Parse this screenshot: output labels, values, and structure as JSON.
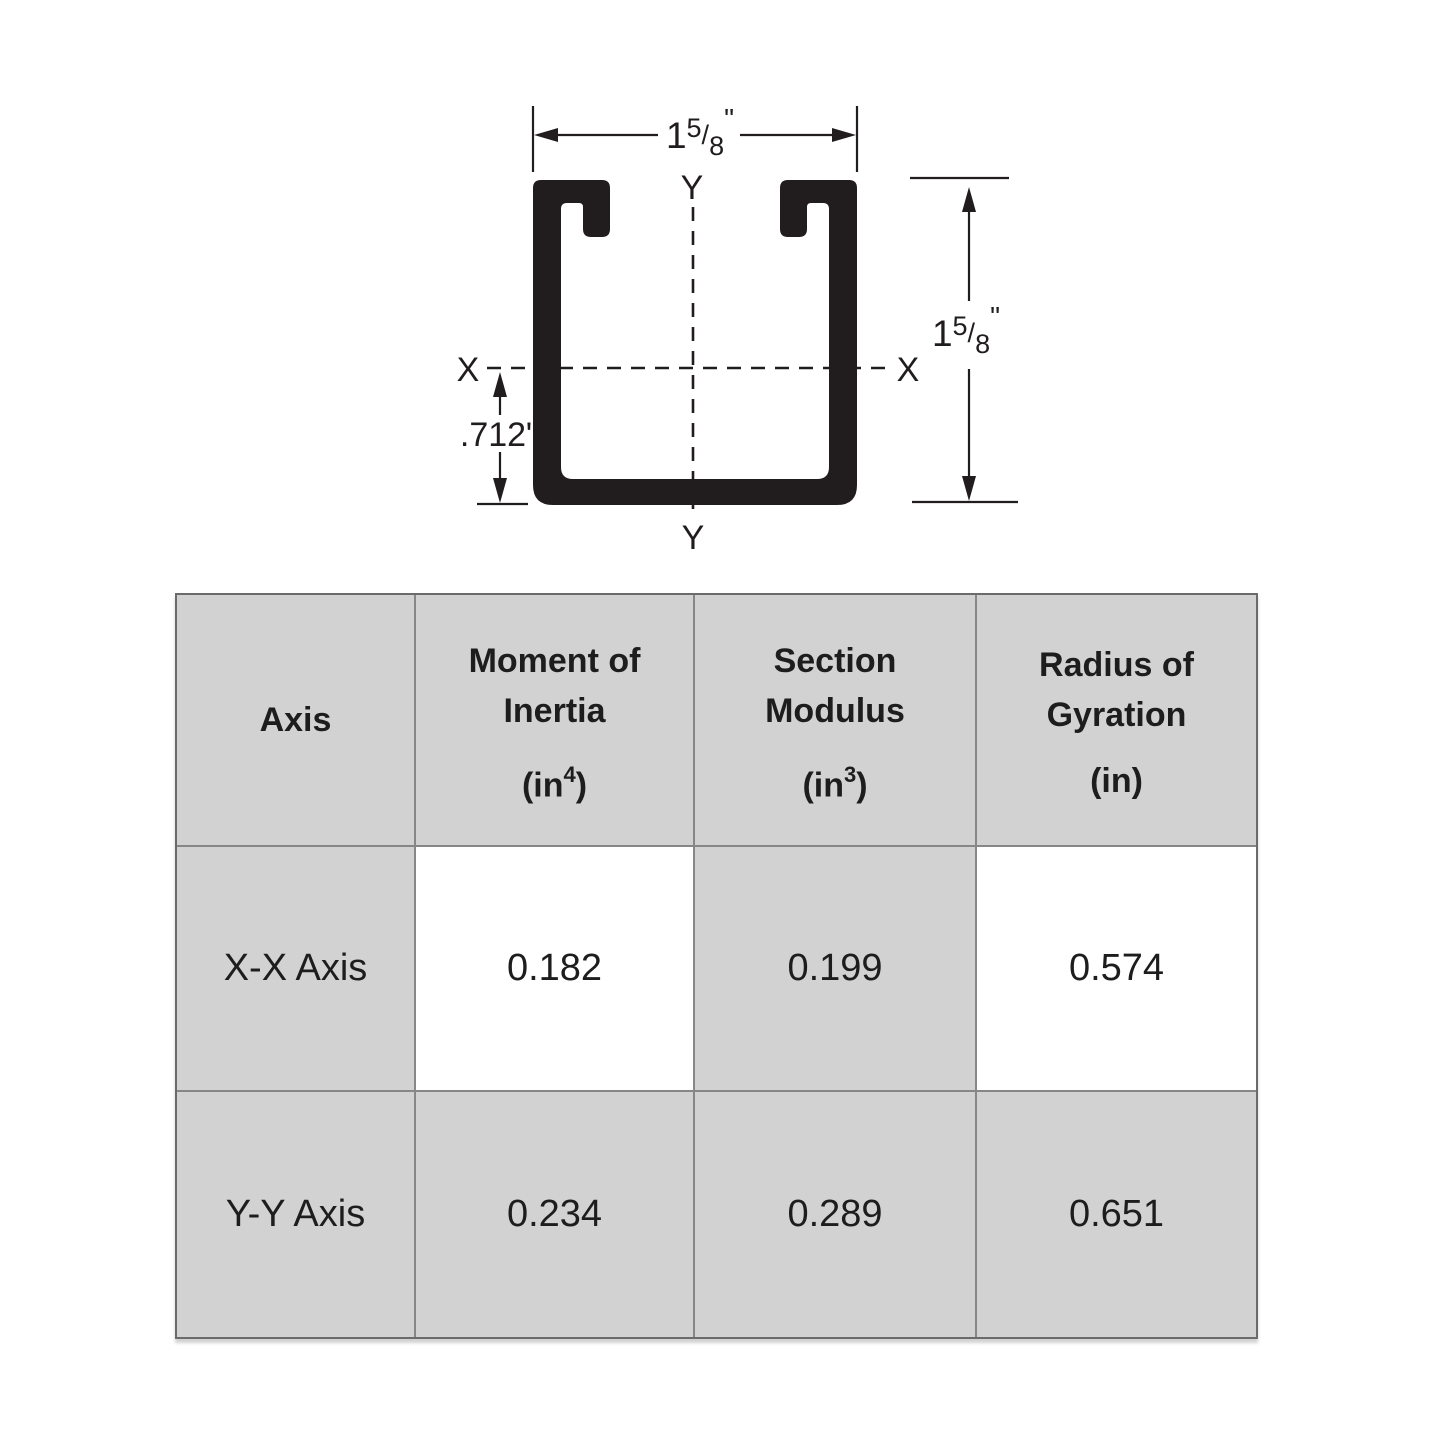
{
  "colors": {
    "ink": "#211d1e",
    "table_cell_gray": "#d2d2d2",
    "table_inner_border": "#878787",
    "table_outer_border": "#6b6b6b",
    "background": "#ffffff"
  },
  "diagram": {
    "width_dim": {
      "whole": "1",
      "num": "5",
      "sep": "/",
      "den": "8",
      "prime": "\""
    },
    "height_dim": {
      "whole": "1",
      "num": "5",
      "sep": "/",
      "den": "8",
      "prime": "\""
    },
    "offset_dim_label": ".712\"",
    "x_axis_label_left": "X",
    "x_axis_label_right": "X",
    "y_axis_label_top": "Y",
    "y_axis_label_bottom": "Y"
  },
  "table": {
    "headers": [
      {
        "line1": "Axis"
      },
      {
        "line1": "Moment of",
        "line2": "Inertia",
        "unit_prefix": "(",
        "unit_base": "in",
        "unit_sup": "4",
        "unit_suffix": ")"
      },
      {
        "line1": "Section",
        "line2": "Modulus",
        "unit_prefix": "(",
        "unit_base": "in",
        "unit_sup": "3",
        "unit_suffix": ")"
      },
      {
        "line1": "Radius of",
        "line2": "Gyration",
        "unit_prefix": "(",
        "unit_base": "in",
        "unit_suffix": ")"
      }
    ],
    "rows": [
      {
        "axis": "X-X Axis",
        "moment_of_inertia": "0.182",
        "section_modulus": "0.199",
        "radius_of_gyration": "0.574"
      },
      {
        "axis": "Y-Y Axis",
        "moment_of_inertia": "0.234",
        "section_modulus": "0.289",
        "radius_of_gyration": "0.651"
      }
    ]
  }
}
